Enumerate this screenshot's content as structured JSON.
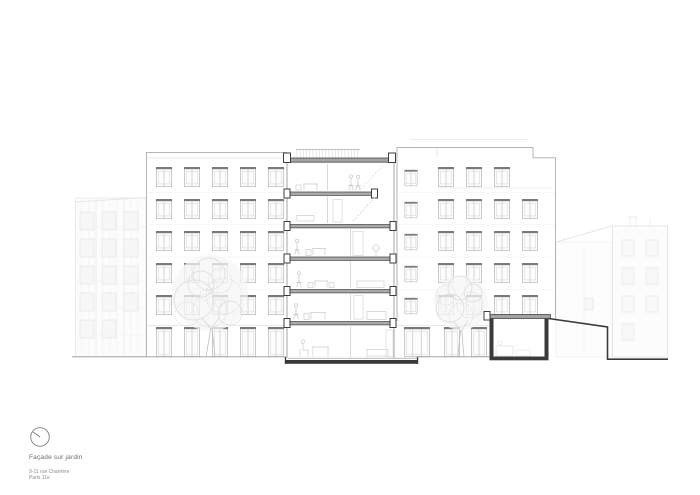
{
  "title_block": {
    "title": "Façade sur jardin",
    "address_line1": "9-11 rue Charrière",
    "address_line2": "Paris 11e"
  },
  "icons": {
    "north_indicator": "circle-with-needle"
  },
  "colors": {
    "section_cut_line": "#3a3a3a",
    "slab_fill": "#a3a3a3",
    "facade_outline": "#b5b5b5",
    "window_lintel": "#7a7a7a",
    "neighbor_building_line": "#e2e2e2",
    "tree_foliage": "#dadada",
    "ground_line": "#9a9a9a",
    "label_text": "#6b6b6b",
    "paper": "#ffffff"
  }
}
